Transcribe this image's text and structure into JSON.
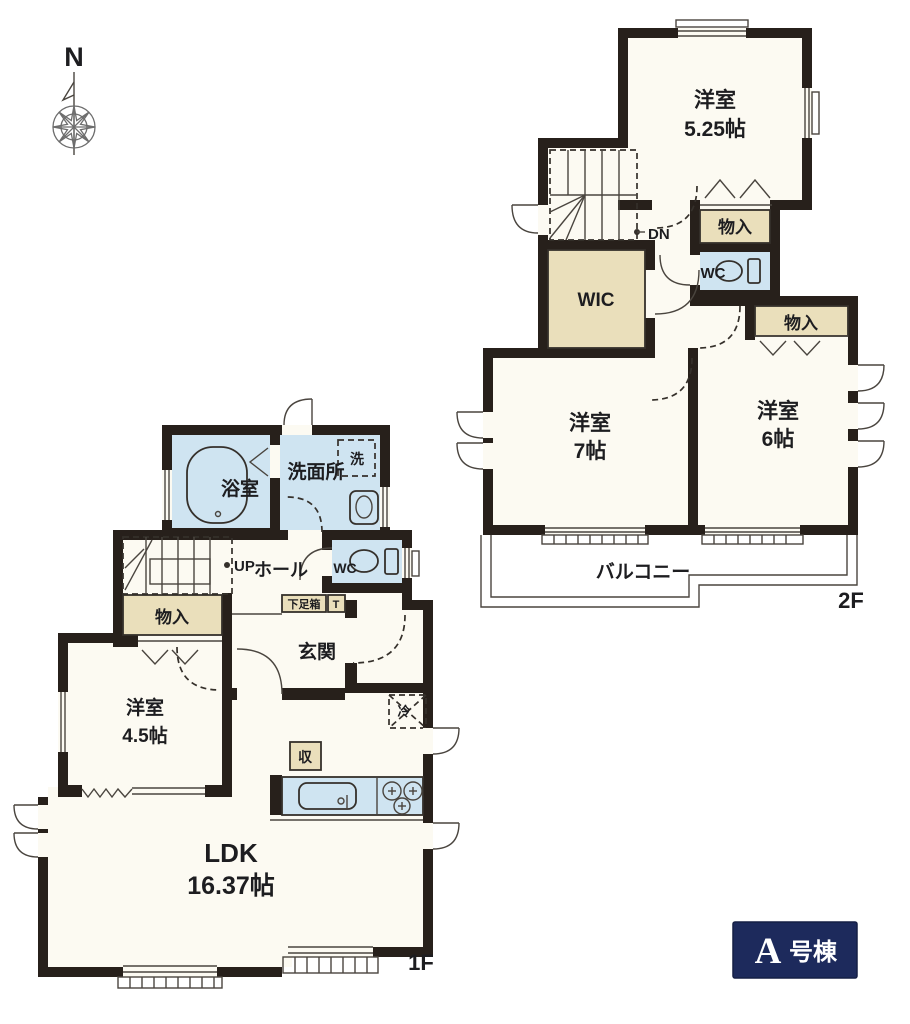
{
  "compass": {
    "north": "N"
  },
  "floor2": {
    "floor_label": "2F",
    "bedroom525": {
      "name": "洋室",
      "size": "5.25帖"
    },
    "bedroom7": {
      "name": "洋室",
      "size": "7帖"
    },
    "bedroom6": {
      "name": "洋室",
      "size": "6帖"
    },
    "closet_top": {
      "label": "物入"
    },
    "closet_side": {
      "label": "物入"
    },
    "wic": {
      "label": "WIC"
    },
    "wc": {
      "label": "WC"
    },
    "balcony": {
      "label": "バルコニー"
    },
    "stairs": {
      "label": "DN"
    }
  },
  "floor1": {
    "floor_label": "1F",
    "bath": {
      "label": "浴室"
    },
    "washroom": {
      "label": "洗面所"
    },
    "laundry": {
      "label": "洗"
    },
    "stairs": {
      "label": "UP"
    },
    "hall": {
      "label": "ホール"
    },
    "wc": {
      "label": "WC"
    },
    "closet": {
      "label": "物入"
    },
    "shoe_box": {
      "label": "下足箱"
    },
    "shoe_box_t": {
      "label": "T"
    },
    "entrance": {
      "label": "玄関"
    },
    "bedroom45": {
      "name": "洋室",
      "size": "4.5帖"
    },
    "refrigerator": {
      "label": "冷"
    },
    "storage": {
      "label": "収"
    },
    "ldk": {
      "name": "LDK",
      "size": "16.37帖"
    }
  },
  "badge": {
    "main": "A",
    "sub": "号棟"
  },
  "colors": {
    "wall": "#27201b",
    "room": "#fcfaf2",
    "water": "#cfe4f1",
    "closet": "#eadfbb",
    "badge": "#1d2a5c",
    "line": "#35302b",
    "paper": "#ffffff"
  }
}
